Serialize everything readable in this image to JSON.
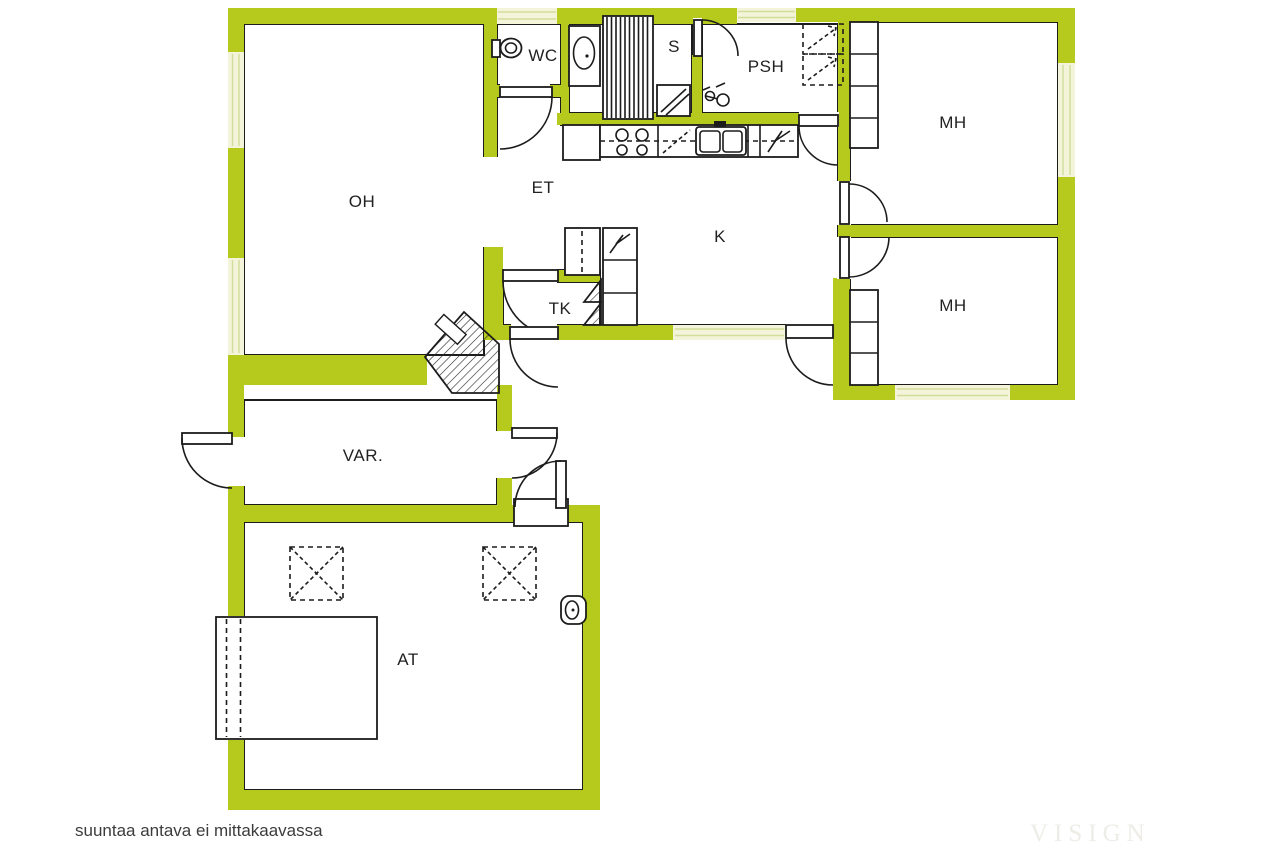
{
  "annotation": "suuntaa antava ei mittakaavassa",
  "watermark": "VISIGN",
  "colors": {
    "wall": "#b6ca1e",
    "window_fill": "#f3f4da",
    "window_line": "#d3dd9a",
    "line": "#1c1c1c",
    "label": "#222222",
    "annotation": "#3c3c3c",
    "watermark": "#edece6"
  },
  "rooms": [
    {
      "id": "oh",
      "label": "OH",
      "x": 362,
      "y": 202
    },
    {
      "id": "wc",
      "label": "WC",
      "x": 543,
      "y": 56
    },
    {
      "id": "s",
      "label": "S",
      "x": 674,
      "y": 47
    },
    {
      "id": "psh",
      "label": "PSH",
      "x": 766,
      "y": 67
    },
    {
      "id": "mh1",
      "label": "MH",
      "x": 953,
      "y": 123
    },
    {
      "id": "mh2",
      "label": "MH",
      "x": 953,
      "y": 306
    },
    {
      "id": "et",
      "label": "ET",
      "x": 543,
      "y": 188
    },
    {
      "id": "k",
      "label": "K",
      "x": 720,
      "y": 237
    },
    {
      "id": "tk",
      "label": "TK",
      "x": 560,
      "y": 309
    },
    {
      "id": "var",
      "label": "VAR.",
      "x": 363,
      "y": 456
    },
    {
      "id": "at",
      "label": "AT",
      "x": 408,
      "y": 660
    }
  ]
}
